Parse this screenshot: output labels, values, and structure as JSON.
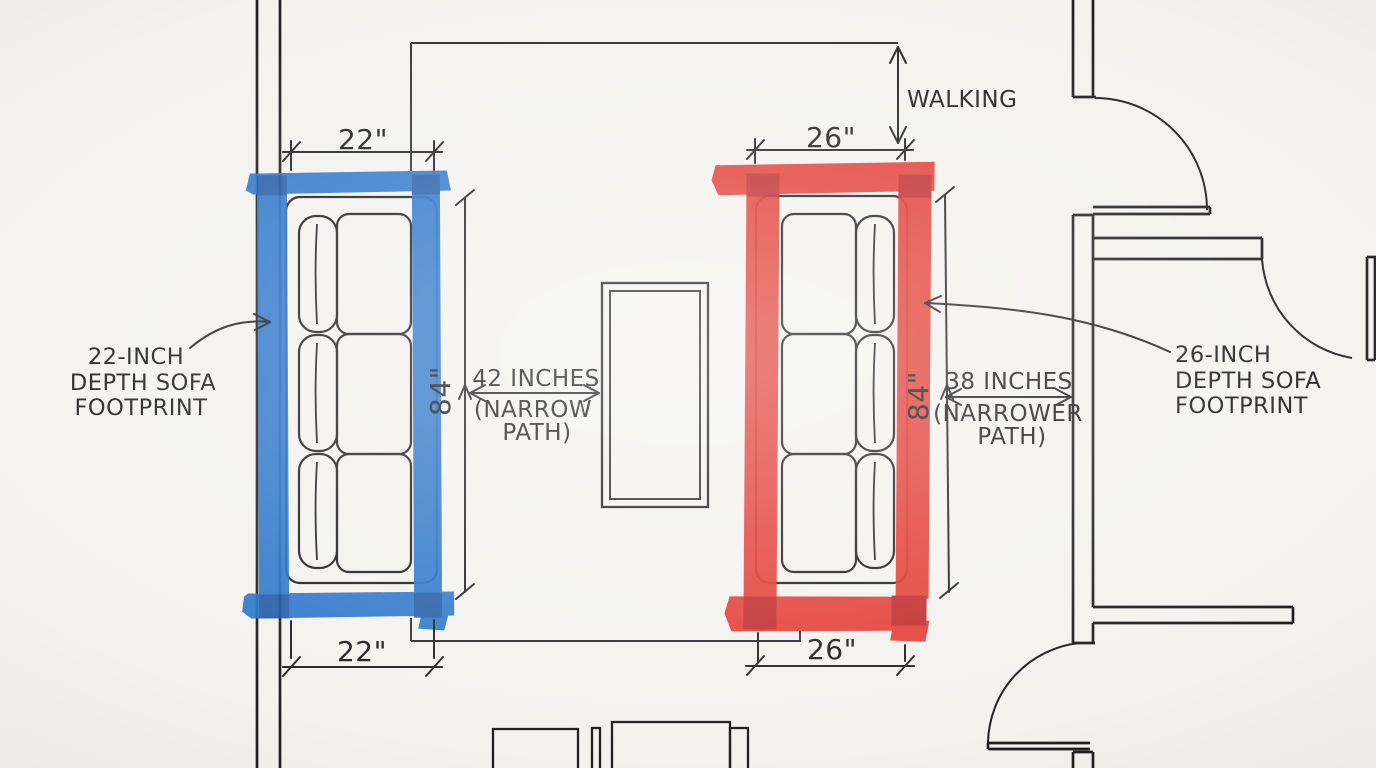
{
  "annotations": {
    "walking_path_label": "WALKING",
    "blue_footprint": {
      "width_top": "22\"",
      "width_bottom": "22\"",
      "length": "84\"",
      "label_lines": [
        "22-INCH",
        "DEPTH SOFA",
        "FOOTPRINT"
      ]
    },
    "red_footprint": {
      "width_top": "26\"",
      "width_bottom": "26\"",
      "length": "84\"",
      "label_lines": [
        "26-INCH",
        "DEPTH SOFA",
        "FOOTPRINT"
      ]
    },
    "center_gap": {
      "lines": [
        "42 INCHES",
        "(NARROW",
        "PATH)"
      ]
    },
    "right_gap": {
      "lines": [
        "38 INCHES",
        "(NARROWER",
        "PATH)"
      ]
    }
  },
  "colors": {
    "paper": "#f3f2ef",
    "ink": "#1f1f22",
    "blue_tape": "#2471c8",
    "blue_tape_dark": "#1a55a5",
    "red_tape": "#e2332a",
    "red_tape_dark": "#bd1e1f"
  }
}
